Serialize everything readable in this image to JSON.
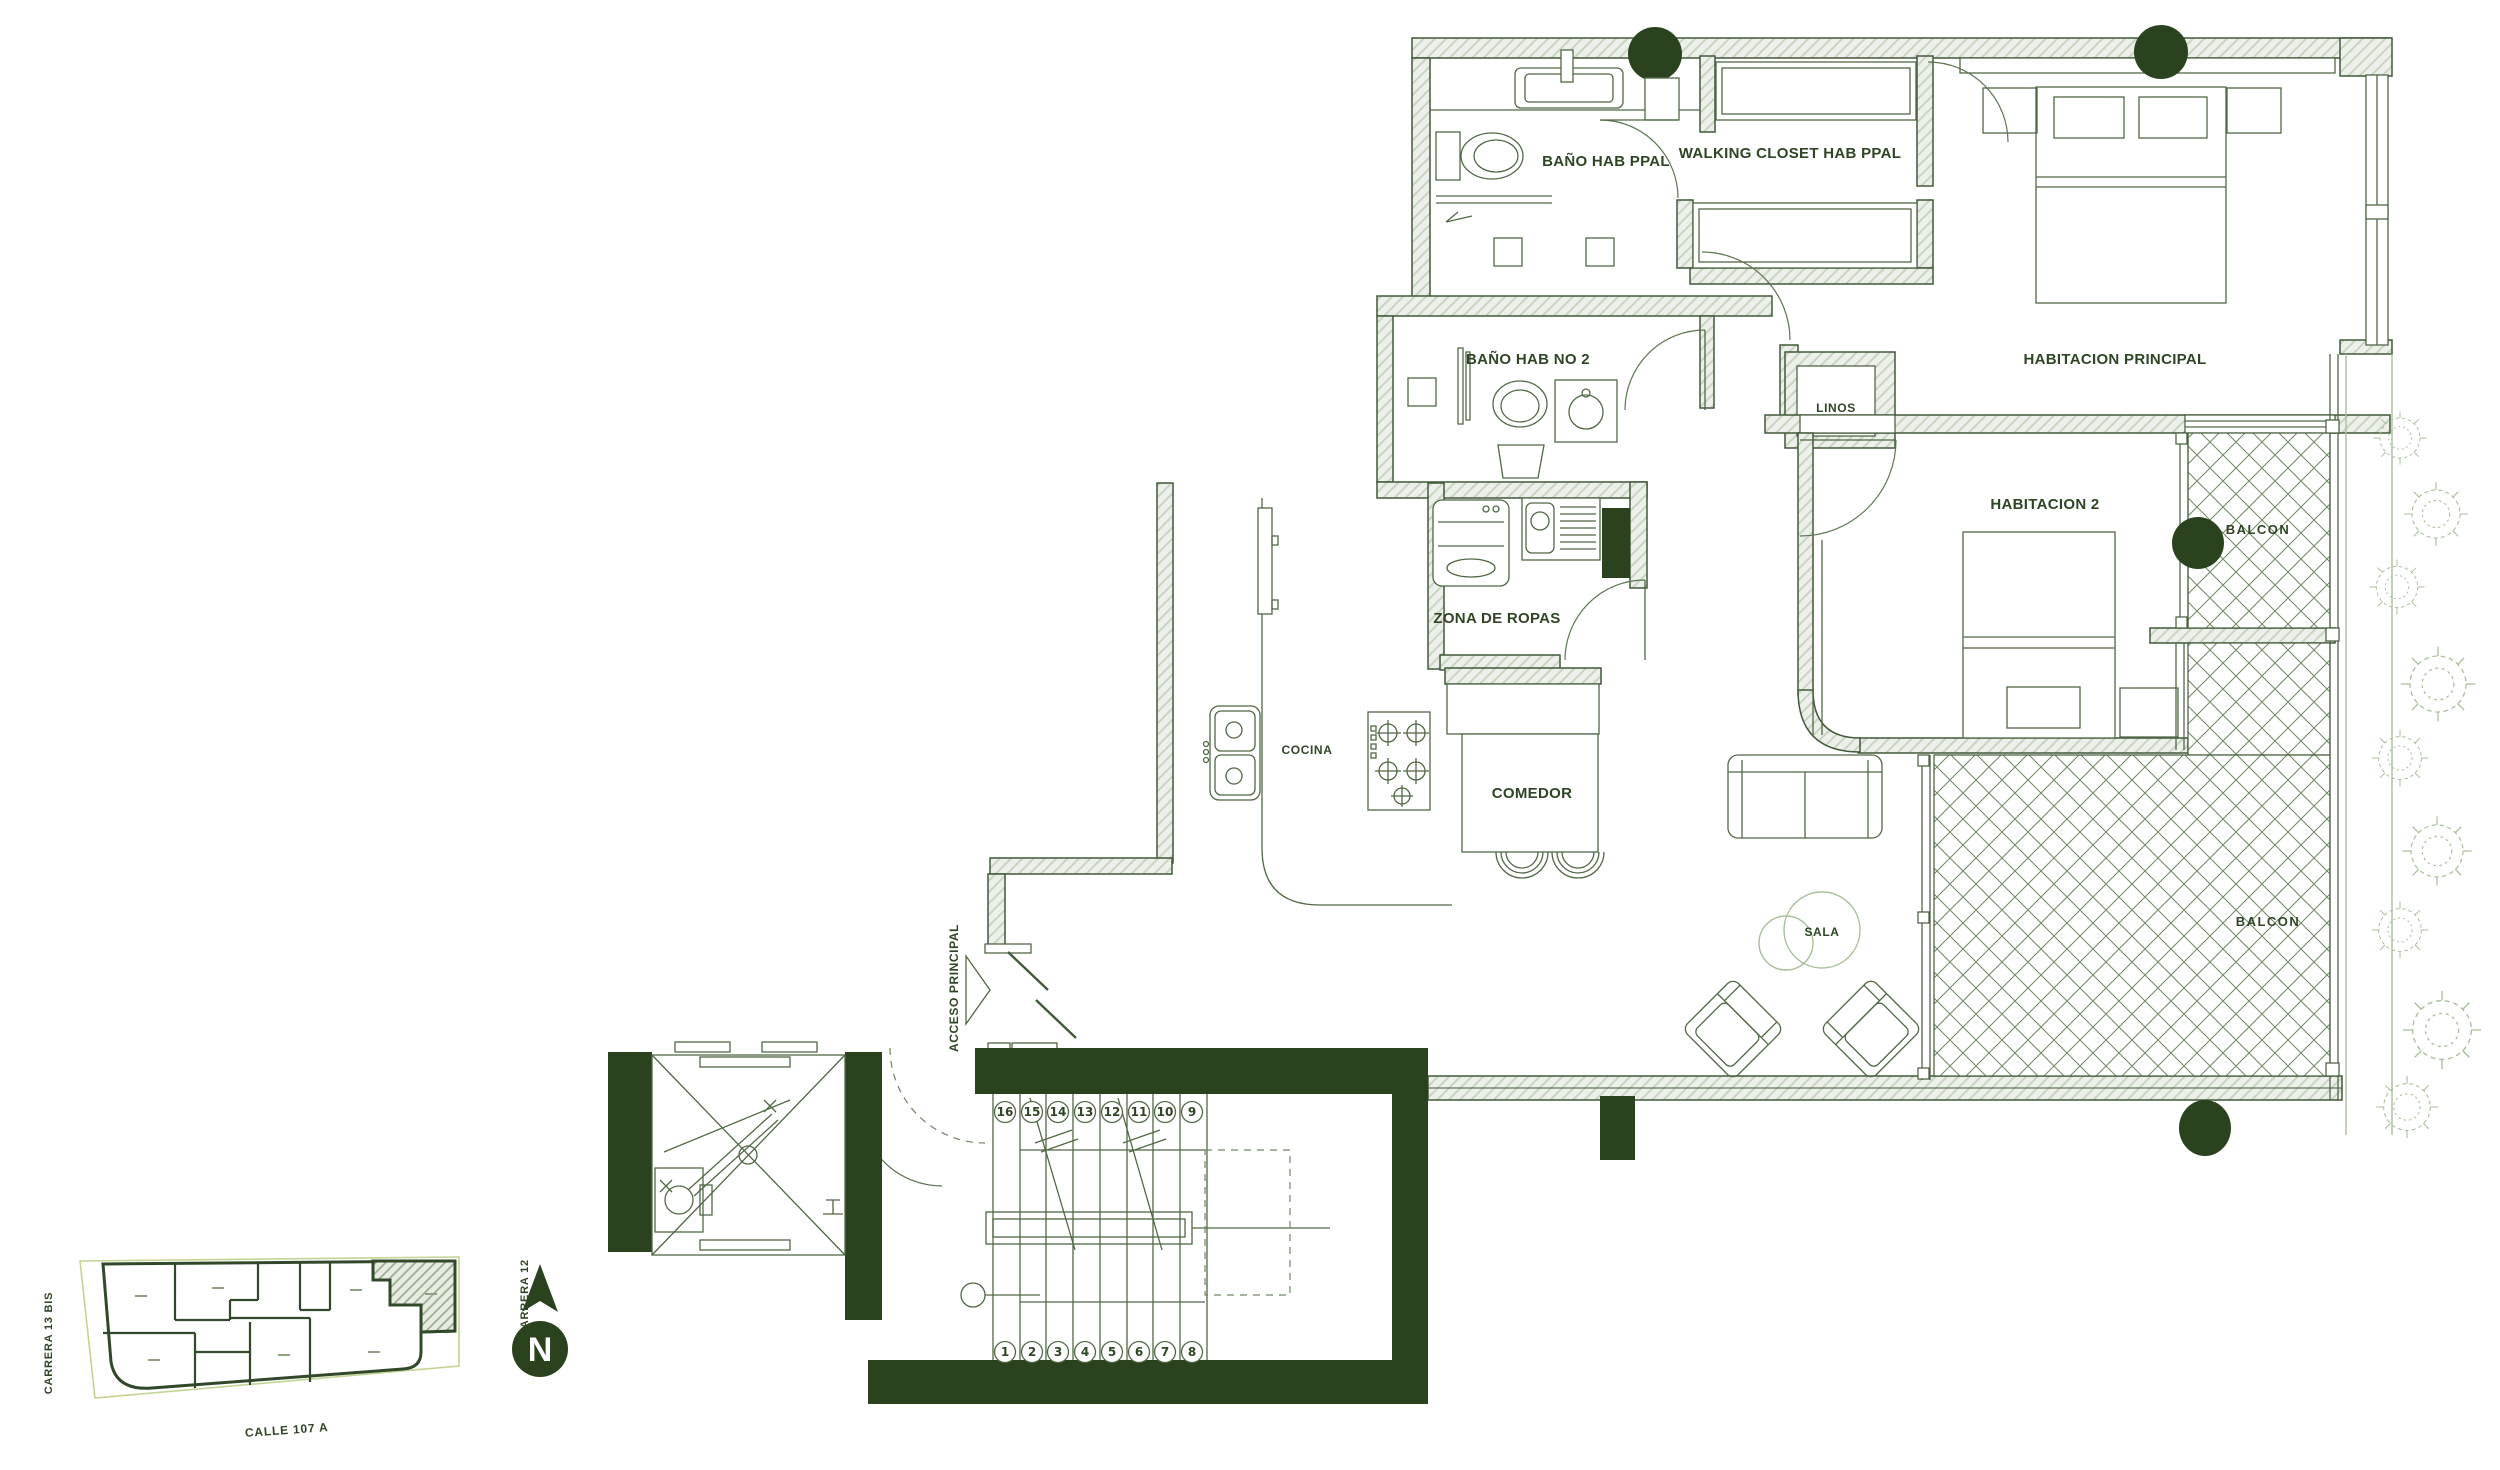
{
  "labels": {
    "bano_ppal": "BAÑO HAB PPAL",
    "walking_closet": "WALKING CLOSET HAB PPAL",
    "hab_ppal": "HABITACION PRINCIPAL",
    "bano2": "BAÑO HAB NO 2",
    "linos": "LINOS",
    "hab2": "HABITACION 2",
    "balcon_upper": "BALCON",
    "balcon_lower": "BALCON",
    "zona_ropas": "ZONA DE ROPAS",
    "cocina": "COCINA",
    "comedor": "COMEDOR",
    "sala": "SALA",
    "acceso": "ACCESO PRINCIPAL"
  },
  "stairs": {
    "top": [
      "16",
      "15",
      "14",
      "13",
      "12",
      "11",
      "10",
      "9"
    ],
    "bottom": [
      "1",
      "2",
      "3",
      "4",
      "5",
      "6",
      "7",
      "8"
    ]
  },
  "site": {
    "carrera13": "CARRERA 13 BIS",
    "carrera12": "CARRERA 12",
    "calle": "CALLE 107 A",
    "north": "N"
  },
  "colors": {
    "ink": "#42593a",
    "text": "#2f4526",
    "dark": "#2b421f",
    "wall_fill": "#edf0ea",
    "wall_hatch": "#c9d4c2",
    "crosshatch": "#6f8764",
    "light": "#a9bf9b",
    "lot": "#c3d494"
  }
}
